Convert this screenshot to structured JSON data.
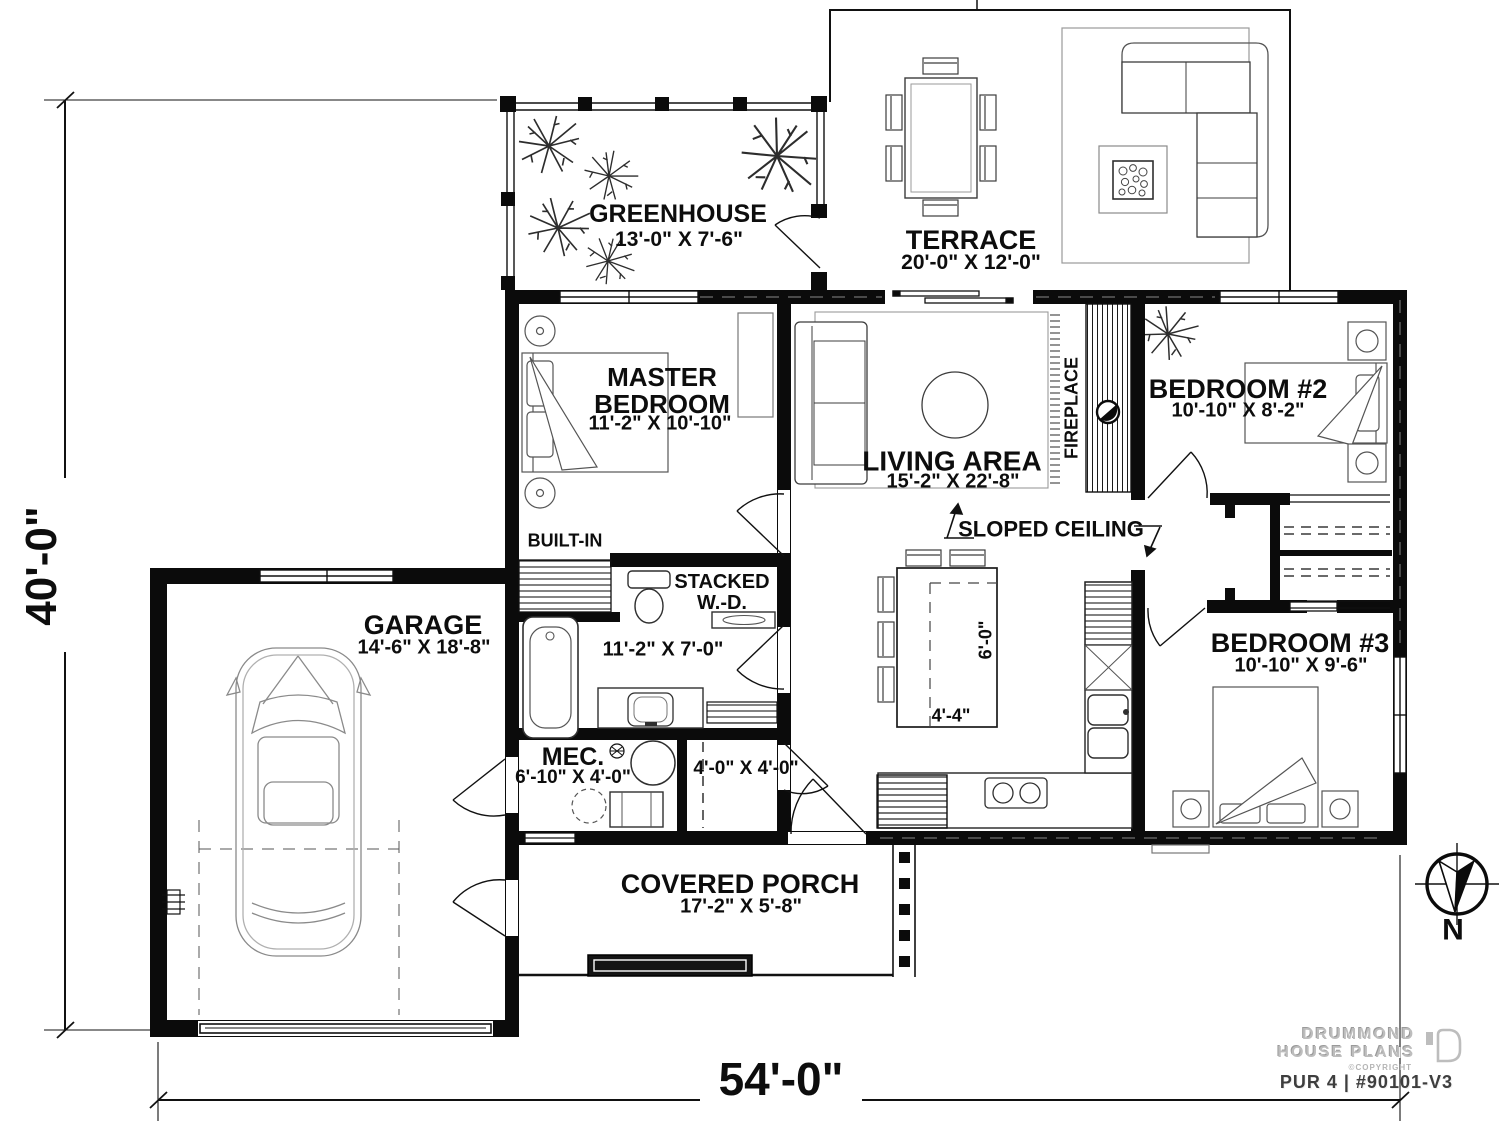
{
  "document": {
    "type": "floor-plan"
  },
  "dimensions": {
    "overall_width": "54'-0\"",
    "overall_depth": "40'-0\""
  },
  "rooms": {
    "greenhouse": {
      "name": "GREENHOUSE",
      "size": "13'-0\" X 7'-6\""
    },
    "terrace": {
      "name": "TERRACE",
      "size": "20'-0\" X 12'-0\""
    },
    "master_bedroom": {
      "name": "MASTER BEDROOM",
      "size": "11'-2\" X 10'-10\""
    },
    "living_area": {
      "name": "LIVING AREA",
      "size": "15'-2\" X 22'-8\""
    },
    "bedroom_2": {
      "name": "BEDROOM #2",
      "size": "10'-10\" X 8'-2\""
    },
    "bedroom_3": {
      "name": "BEDROOM #3",
      "size": "10'-10\" X 9'-6\""
    },
    "bathroom": {
      "size": "11'-2\" X 7'-0\""
    },
    "mechanical": {
      "name": "MEC.",
      "size": "6'-10\" X 4'-0\""
    },
    "entry_closet": {
      "size": "4'-0\" X 4'-0\""
    },
    "garage": {
      "name": "GARAGE",
      "size": "14'-6\" X 18'-8\""
    },
    "covered_porch": {
      "name": "COVERED PORCH",
      "size": "17'-2\" X 5'-8\""
    }
  },
  "annotations": {
    "built_in": "BUILT-IN",
    "stacked_wd": "STACKED W.-D.",
    "fireplace": "FIREPLACE",
    "sloped_ceiling": "SLOPED CEILING",
    "island_depth": "6'-0\"",
    "island_width": "4'-4\"",
    "compass_north": "N"
  },
  "title_block": {
    "brand_line1": "DRUMMOND",
    "brand_line2": "HOUSE PLANS",
    "copyright": "©COPYRIGHT",
    "plan_id": "PUR 4 | #90101-V3"
  },
  "colors": {
    "ink": "#0b0b0b",
    "furniture": "#3c3c3c",
    "light_line": "#8a8a8a",
    "logo_gray": "#bdbdbd"
  }
}
